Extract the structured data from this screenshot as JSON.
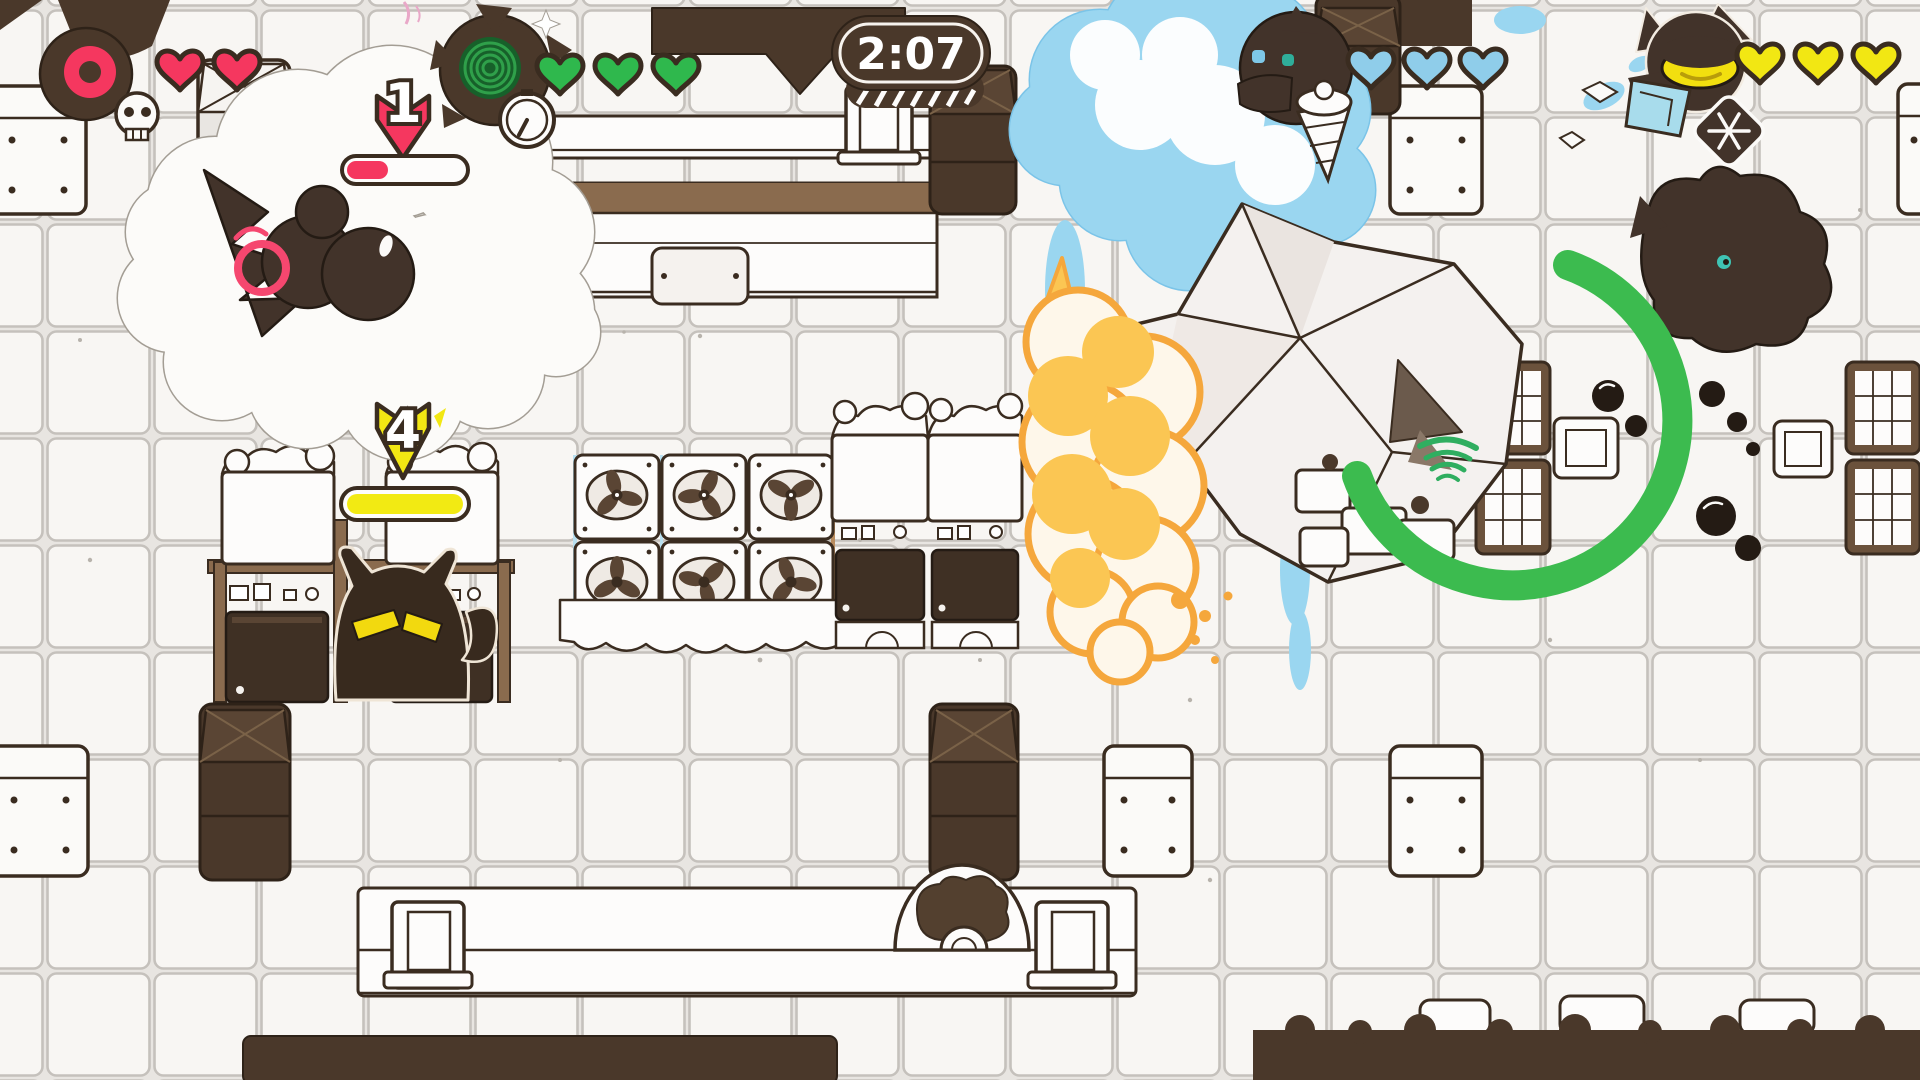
{
  "hud": {
    "timer": {
      "value": "2:07"
    },
    "players": [
      {
        "label": "player-1",
        "portrait": "blob-with-donut",
        "hearts": 2,
        "heart_color": "#F5375F",
        "status_icon": "skull-icon"
      },
      {
        "label": "player-2",
        "portrait": "horned-swirl-creature",
        "hearts": 3,
        "heart_color": "#2FB84D",
        "status_icon": "clock-icon",
        "drop_marker": {
          "label": "1",
          "color": "#F5375F"
        },
        "meter": {
          "fill": 0.35,
          "color": "#F5375F"
        }
      },
      {
        "label": "player-3",
        "portrait": "dolphin-with-ice-cream",
        "hearts": 3,
        "heart_color": "#8FCDEA"
      },
      {
        "label": "player-4",
        "portrait": "cat-with-yellow-eye",
        "hearts": 3,
        "heart_color": "#F2E713",
        "status_icon": "snowflake-icon"
      }
    ]
  },
  "arena": {
    "cat_character": {
      "drop_marker": {
        "label": "4",
        "color": "#F2E713"
      },
      "meter": {
        "fill": 1,
        "color": "#F2EA13"
      }
    },
    "effects": [
      "white-smoke-cloud",
      "ice-explosion",
      "fire-explosion",
      "green-ring",
      "crystal-die"
    ],
    "props": [
      "tile-floor",
      "conveyor-belts",
      "fan-vents",
      "vending-machines",
      "hex-barrels",
      "dot-crates",
      "radiators"
    ]
  },
  "colors": {
    "outline": "#3A2C20",
    "dark_fill": "#4A382A",
    "tile": "#F8F6F3",
    "grout": "#C5C1BC",
    "heart_red": "#F5375F",
    "heart_green": "#2FB84D",
    "heart_blue": "#8FCDEA",
    "heart_yellow": "#F2E713",
    "ice_blue": "#9AD6F0",
    "explosion_orange": "#F5A73C",
    "explosion_yellow": "#FBC653",
    "ring_green": "#3CBB4F"
  }
}
